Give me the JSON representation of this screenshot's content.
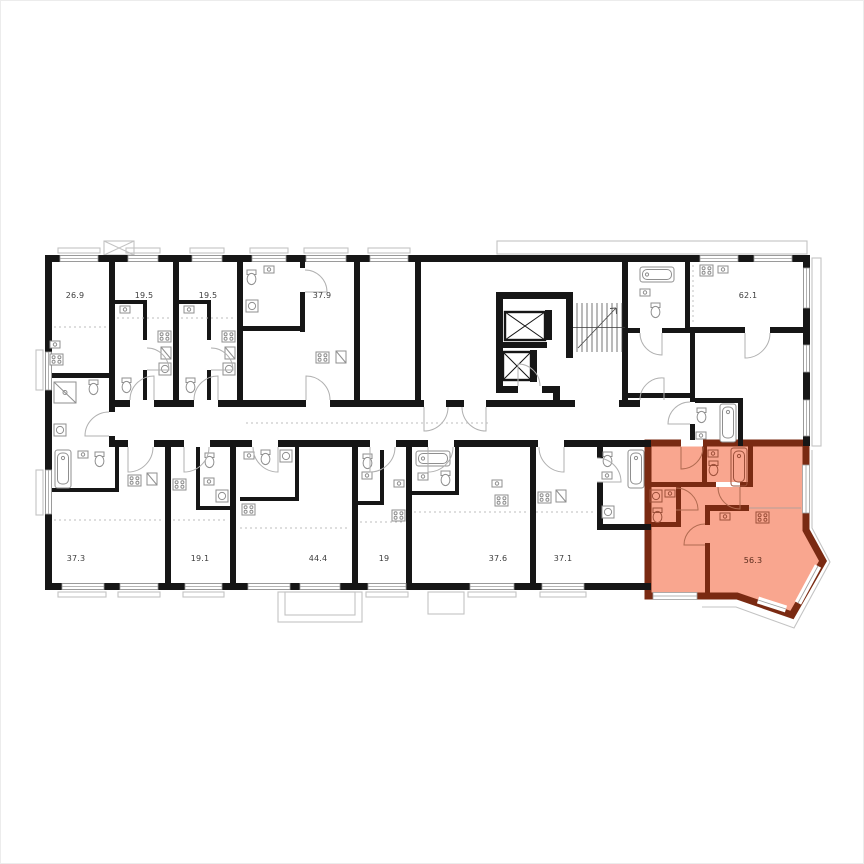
{
  "floor_plan": {
    "units": [
      {
        "name": "unit-top-1",
        "area": "26.9",
        "row": "top",
        "highlighted": false
      },
      {
        "name": "unit-top-2",
        "area": "19.5",
        "row": "top",
        "highlighted": false
      },
      {
        "name": "unit-top-3",
        "area": "19.5",
        "row": "top",
        "highlighted": false
      },
      {
        "name": "unit-top-4",
        "area": "37.9",
        "row": "top",
        "highlighted": false
      },
      {
        "name": "unit-top-5",
        "area": "62.1",
        "row": "top",
        "highlighted": false
      },
      {
        "name": "unit-bottom-1",
        "area": "37.3",
        "row": "bottom",
        "highlighted": false
      },
      {
        "name": "unit-bottom-2",
        "area": "19.1",
        "row": "bottom",
        "highlighted": false
      },
      {
        "name": "unit-bottom-3",
        "area": "44.4",
        "row": "bottom",
        "highlighted": false
      },
      {
        "name": "unit-bottom-4",
        "area": "19",
        "row": "bottom",
        "highlighted": false
      },
      {
        "name": "unit-bottom-5",
        "area": "37.6",
        "row": "bottom",
        "highlighted": false
      },
      {
        "name": "unit-bottom-6",
        "area": "37.1",
        "row": "bottom",
        "highlighted": false
      },
      {
        "name": "unit-selected",
        "area": "56.3",
        "row": "bottom",
        "highlighted": true
      }
    ],
    "selected_unit": {
      "area": "56.3"
    },
    "colors": {
      "highlight_fill": "#F9A68F",
      "highlight_wall": "#7A2A12",
      "wall": "#161616",
      "facade_outline": "#C3C3C3",
      "fixture_stroke": "#8F8F8F",
      "label": "#3D3D3D"
    },
    "icons": [
      "elevator-shaft-icon",
      "stairs-icon",
      "bathtub-icon",
      "toilet-icon",
      "sink-icon",
      "stove-icon",
      "washing-machine-icon",
      "door-swing-icon"
    ]
  }
}
